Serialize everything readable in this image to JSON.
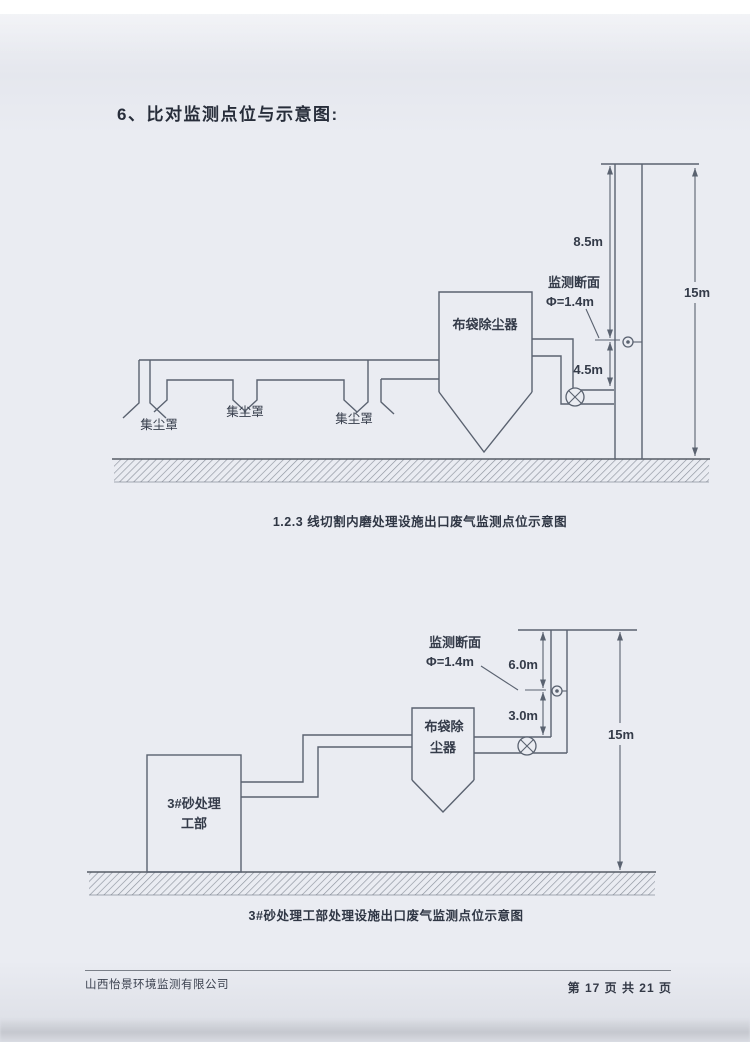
{
  "page": {
    "title": "6、比对监测点位与示意图:"
  },
  "colors": {
    "page_bg": "#eaecf2",
    "line": "#5a6270",
    "ink": "#343b49",
    "hatch": "#8d939e"
  },
  "diagram1": {
    "caption": "1.2.3 线切割内磨处理设施出口废气监测点位示意图",
    "labels": {
      "hood1": "集尘罩",
      "hood2": "集尘罩",
      "hood3": "集尘罩",
      "baghouse": "布袋除尘器",
      "section_line1": "监测断面",
      "section_line2": "Φ=1.4m",
      "dim_upper": "8.5m",
      "dim_lower": "4.5m",
      "dim_total": "15m"
    }
  },
  "diagram2": {
    "caption": "3#砂处理工部处理设施出口废气监测点位示意图",
    "labels": {
      "workshop_line1": "3#砂处理",
      "workshop_line2": "工部",
      "baghouse_line1": "布袋除",
      "baghouse_line2": "尘器",
      "section_line1": "监测断面",
      "section_line2": "Φ=1.4m",
      "dim_upper": "6.0m",
      "dim_lower": "3.0m",
      "dim_total": "15m"
    }
  },
  "footer": {
    "company": "山西怡景环境监测有限公司",
    "page_info": "第 17 页 共 21 页"
  }
}
